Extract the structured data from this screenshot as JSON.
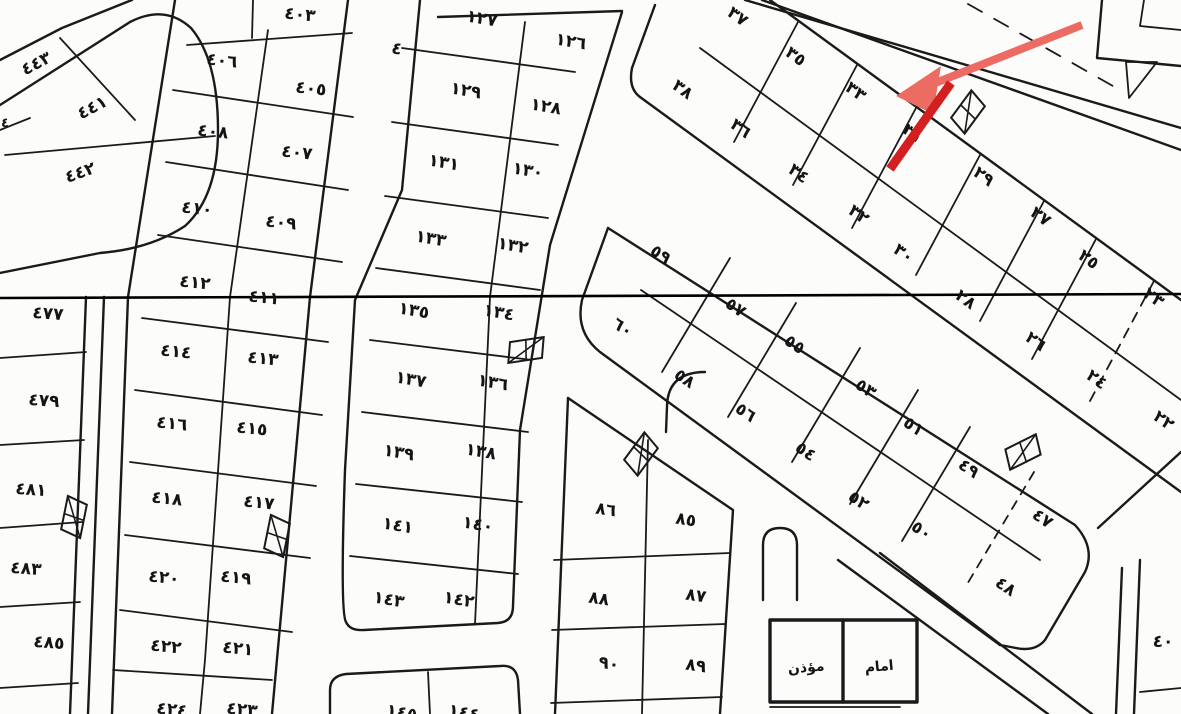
{
  "map": {
    "type": "cadastral-plat-scan",
    "background": "#fcfcfb",
    "line_color": "#1a1a1a",
    "section_line_y": 297,
    "annotation": {
      "arrow_color_light": "#ec6b62",
      "arrow_color_dark": "#d31f1f",
      "light_line": [
        [
          1082,
          25
        ],
        [
          915,
          91
        ]
      ],
      "head": [
        [
          896,
          96
        ],
        [
          941,
          66
        ],
        [
          933,
          114
        ]
      ],
      "dark_line": [
        [
          951,
          83
        ],
        [
          890,
          169
        ]
      ],
      "points_at_parcel": "٣١"
    },
    "street_symbol": {
      "text": "٤",
      "x": 397,
      "y": 48,
      "r": 12
    }
  },
  "parcel_labels": [
    {
      "text": "٤٤٣",
      "x": 36,
      "y": 63,
      "r": -28
    },
    {
      "text": "٤٤١",
      "x": 92,
      "y": 107,
      "r": -28
    },
    {
      "text": "٤٤٢",
      "x": 80,
      "y": 172,
      "r": -20
    },
    {
      "text": "٤",
      "x": 5,
      "y": 121,
      "r": 0
    },
    {
      "text": "٤٠٣",
      "x": 300,
      "y": 14,
      "r": 6
    },
    {
      "text": "٤٠٦",
      "x": 222,
      "y": 60,
      "r": 6
    },
    {
      "text": "٤٠٥",
      "x": 311,
      "y": 88,
      "r": 6
    },
    {
      "text": "٤٠٨",
      "x": 213,
      "y": 131,
      "r": 6
    },
    {
      "text": "٤٠٧",
      "x": 297,
      "y": 152,
      "r": 6
    },
    {
      "text": "٤١٠",
      "x": 197,
      "y": 208,
      "r": 6
    },
    {
      "text": "٤٠٩",
      "x": 281,
      "y": 222,
      "r": 6
    },
    {
      "text": "٤١٢",
      "x": 195,
      "y": 282,
      "r": 6
    },
    {
      "text": "٤١١",
      "x": 264,
      "y": 297,
      "r": 6
    },
    {
      "text": "٤١٤",
      "x": 176,
      "y": 351,
      "r": 6
    },
    {
      "text": "٤١٣",
      "x": 263,
      "y": 358,
      "r": 6
    },
    {
      "text": "٤١٦",
      "x": 172,
      "y": 423,
      "r": 6
    },
    {
      "text": "٤١٥",
      "x": 252,
      "y": 428,
      "r": 6
    },
    {
      "text": "٤١٨",
      "x": 167,
      "y": 498,
      "r": 6
    },
    {
      "text": "٤١٧",
      "x": 259,
      "y": 502,
      "r": 6
    },
    {
      "text": "٤٢٠",
      "x": 164,
      "y": 577,
      "r": 6
    },
    {
      "text": "٤١٩",
      "x": 236,
      "y": 577,
      "r": 6
    },
    {
      "text": "٤٢٢",
      "x": 166,
      "y": 646,
      "r": 6
    },
    {
      "text": "٤٢١",
      "x": 238,
      "y": 648,
      "r": 6
    },
    {
      "text": "٤٢٤",
      "x": 172,
      "y": 709,
      "r": 6
    },
    {
      "text": "٤٢٣",
      "x": 242,
      "y": 709,
      "r": 6
    },
    {
      "text": "٤٧٧",
      "x": 48,
      "y": 313,
      "r": 4
    },
    {
      "text": "٤٧٩",
      "x": 44,
      "y": 400,
      "r": 4
    },
    {
      "text": "٤٨١",
      "x": 31,
      "y": 489,
      "r": 4
    },
    {
      "text": "٤٨٣",
      "x": 26,
      "y": 568,
      "r": 4
    },
    {
      "text": "٤٨٥",
      "x": 49,
      "y": 642,
      "r": 4
    },
    {
      "text": "١٢٧",
      "x": 482,
      "y": 18,
      "r": 10
    },
    {
      "text": "١٢٦",
      "x": 571,
      "y": 41,
      "r": 10
    },
    {
      "text": "١٢٩",
      "x": 466,
      "y": 90,
      "r": 10
    },
    {
      "text": "١٢٨",
      "x": 546,
      "y": 106,
      "r": 10
    },
    {
      "text": "١٣١",
      "x": 444,
      "y": 162,
      "r": 10
    },
    {
      "text": "١٣٠",
      "x": 528,
      "y": 170,
      "r": 10
    },
    {
      "text": "١٣٣",
      "x": 431,
      "y": 238,
      "r": 10
    },
    {
      "text": "١٣٢",
      "x": 513,
      "y": 245,
      "r": 10
    },
    {
      "text": "١٣٥",
      "x": 414,
      "y": 310,
      "r": 10
    },
    {
      "text": "١٣٤",
      "x": 499,
      "y": 312,
      "r": 10
    },
    {
      "text": "١٣٧",
      "x": 411,
      "y": 379,
      "r": 10
    },
    {
      "text": "١٣٦",
      "x": 493,
      "y": 382,
      "r": 10
    },
    {
      "text": "١٣٩",
      "x": 399,
      "y": 452,
      "r": 10
    },
    {
      "text": "١٣٨",
      "x": 481,
      "y": 451,
      "r": 10
    },
    {
      "text": "١٤١",
      "x": 398,
      "y": 525,
      "r": 10
    },
    {
      "text": "١٤٠",
      "x": 478,
      "y": 524,
      "r": 10
    },
    {
      "text": "١٤٣",
      "x": 389,
      "y": 599,
      "r": 10
    },
    {
      "text": "١٤٢",
      "x": 459,
      "y": 599,
      "r": 10
    },
    {
      "text": "١٤٥",
      "x": 402,
      "y": 712,
      "r": 10
    },
    {
      "text": "١٤٤",
      "x": 464,
      "y": 712,
      "r": 10
    },
    {
      "text": "٣٧",
      "x": 738,
      "y": 16,
      "r": 36
    },
    {
      "text": "٣٥",
      "x": 796,
      "y": 56,
      "r": 36
    },
    {
      "text": "٣٣",
      "x": 856,
      "y": 91,
      "r": 36
    },
    {
      "text": "٣١",
      "x": 913,
      "y": 133,
      "r": 36
    },
    {
      "text": "٢٩",
      "x": 984,
      "y": 176,
      "r": 36
    },
    {
      "text": "٢٧",
      "x": 1041,
      "y": 216,
      "r": 36
    },
    {
      "text": "٢٥",
      "x": 1089,
      "y": 259,
      "r": 36
    },
    {
      "text": "٢٣",
      "x": 1154,
      "y": 297,
      "r": 36
    },
    {
      "text": "٣٨",
      "x": 683,
      "y": 89,
      "r": 36
    },
    {
      "text": "٣٦",
      "x": 741,
      "y": 128,
      "r": 36
    },
    {
      "text": "٣٤",
      "x": 799,
      "y": 173,
      "r": 36
    },
    {
      "text": "٣٢",
      "x": 859,
      "y": 214,
      "r": 36
    },
    {
      "text": "٣٠",
      "x": 904,
      "y": 253,
      "r": 36
    },
    {
      "text": "٢٨",
      "x": 966,
      "y": 299,
      "r": 36
    },
    {
      "text": "٢٦",
      "x": 1036,
      "y": 341,
      "r": 36
    },
    {
      "text": "٢٤",
      "x": 1097,
      "y": 379,
      "r": 36
    },
    {
      "text": "٢٢",
      "x": 1164,
      "y": 420,
      "r": 36
    },
    {
      "text": "٥٩",
      "x": 661,
      "y": 254,
      "r": 34
    },
    {
      "text": "٥٧",
      "x": 736,
      "y": 307,
      "r": 34
    },
    {
      "text": "٥٥",
      "x": 795,
      "y": 344,
      "r": 34
    },
    {
      "text": "٥٣",
      "x": 866,
      "y": 388,
      "r": 34
    },
    {
      "text": "٥١",
      "x": 914,
      "y": 426,
      "r": 34
    },
    {
      "text": "٤٩",
      "x": 969,
      "y": 468,
      "r": 34
    },
    {
      "text": "٤٧",
      "x": 1043,
      "y": 518,
      "r": 34
    },
    {
      "text": "٦٠",
      "x": 623,
      "y": 327,
      "r": 34
    },
    {
      "text": "٥٨",
      "x": 685,
      "y": 378,
      "r": 34
    },
    {
      "text": "٥٦",
      "x": 746,
      "y": 412,
      "r": 34
    },
    {
      "text": "٥٤",
      "x": 806,
      "y": 451,
      "r": 34
    },
    {
      "text": "٥٢",
      "x": 859,
      "y": 500,
      "r": 34
    },
    {
      "text": "٥٠",
      "x": 922,
      "y": 530,
      "r": 34
    },
    {
      "text": "٤٨",
      "x": 1006,
      "y": 586,
      "r": 34
    },
    {
      "text": "٨٦",
      "x": 606,
      "y": 509,
      "r": 8
    },
    {
      "text": "٨٥",
      "x": 686,
      "y": 519,
      "r": 8
    },
    {
      "text": "٨٨",
      "x": 599,
      "y": 598,
      "r": 8
    },
    {
      "text": "٨٧",
      "x": 696,
      "y": 595,
      "r": 8
    },
    {
      "text": "٩٠",
      "x": 609,
      "y": 663,
      "r": 8
    },
    {
      "text": "٨٩",
      "x": 696,
      "y": 665,
      "r": 8
    },
    {
      "text": "٤٠",
      "x": 1163,
      "y": 641,
      "r": 0
    }
  ],
  "room_labels": [
    {
      "text": "مؤذن",
      "x": 806,
      "y": 666,
      "r": -5
    },
    {
      "text": "امام",
      "x": 879,
      "y": 665,
      "r": -5
    }
  ],
  "survey_flags": [
    {
      "x": 74,
      "y": 517,
      "r": 8
    },
    {
      "x": 277,
      "y": 536,
      "r": 8
    },
    {
      "x": 526,
      "y": 350,
      "r": 78
    },
    {
      "x": 641,
      "y": 454,
      "r": 33
    },
    {
      "x": 1023,
      "y": 452,
      "r": -120
    },
    {
      "x": 968,
      "y": 112,
      "r": 33
    }
  ]
}
